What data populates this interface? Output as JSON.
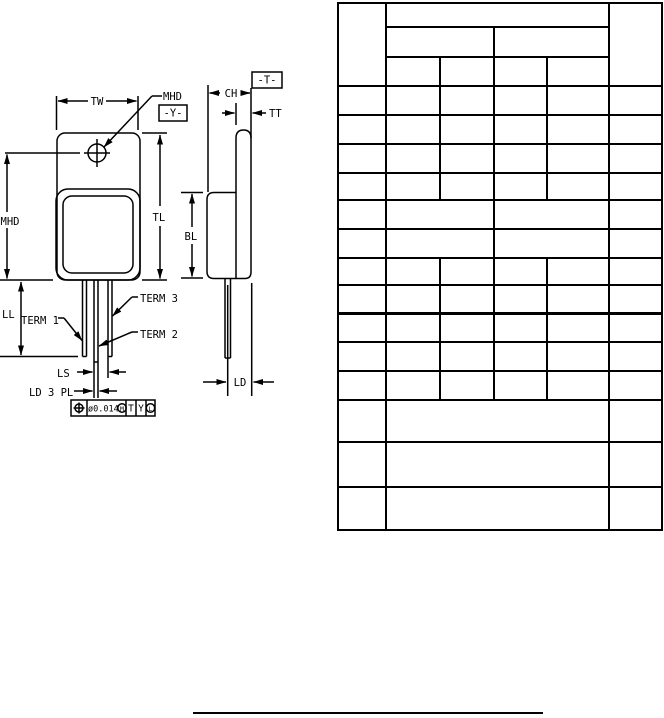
{
  "colors": {
    "ink": "#000000",
    "paper": "#ffffff"
  },
  "drawing": {
    "labels": {
      "tw": "TW",
      "mhd_leader": "MHD",
      "datum_y": "-Y-",
      "ch": "CH",
      "datum_t": "-T-",
      "tt": "TT",
      "tl": "TL",
      "bl": "BL",
      "mhd": "MHD",
      "ll": "LL",
      "term1": "TERM 1",
      "term2": "TERM 2",
      "term3": "TERM 3",
      "ls": "LS",
      "ld_3pl": "LD 3 PL",
      "ld": "LD"
    },
    "fcf": {
      "tolerance": "ø0.014",
      "modifier": "M",
      "datum_primary": "T",
      "datum_secondary": "Y",
      "datum_tertiary": "L"
    }
  },
  "table": {
    "left": 338,
    "top": 3,
    "width": 324,
    "height": 527,
    "h_lines": [
      {
        "y": 0,
        "x1": 0,
        "x2": 324
      },
      {
        "y": 24,
        "x1": 48,
        "x2": 271
      },
      {
        "y": 54,
        "x1": 48,
        "x2": 271
      },
      {
        "y": 83,
        "x1": 0,
        "x2": 324
      },
      {
        "y": 112,
        "x1": 0,
        "x2": 324
      },
      {
        "y": 141,
        "x1": 0,
        "x2": 324
      },
      {
        "y": 170,
        "x1": 0,
        "x2": 324
      },
      {
        "y": 197,
        "x1": 0,
        "x2": 324
      },
      {
        "y": 226,
        "x1": 0,
        "x2": 324
      },
      {
        "y": 255,
        "x1": 0,
        "x2": 324
      },
      {
        "y": 282,
        "x1": 0,
        "x2": 324
      },
      {
        "y": 310,
        "x1": 0,
        "x2": 324,
        "thick": true
      },
      {
        "y": 339,
        "x1": 0,
        "x2": 324
      },
      {
        "y": 368,
        "x1": 0,
        "x2": 324
      },
      {
        "y": 397,
        "x1": 0,
        "x2": 324
      },
      {
        "y": 439,
        "x1": 0,
        "x2": 324
      },
      {
        "y": 484,
        "x1": 0,
        "x2": 324
      },
      {
        "y": 527,
        "x1": 0,
        "x2": 324
      }
    ],
    "v_lines": [
      {
        "x": 0,
        "y1": 0,
        "y2": 527
      },
      {
        "x": 48,
        "y1": 0,
        "y2": 527
      },
      {
        "x": 102,
        "y1": 54,
        "y2": 197
      },
      {
        "x": 102,
        "y1": 255,
        "y2": 397
      },
      {
        "x": 156,
        "y1": 24,
        "y2": 397
      },
      {
        "x": 209,
        "y1": 54,
        "y2": 197
      },
      {
        "x": 209,
        "y1": 255,
        "y2": 397
      },
      {
        "x": 271,
        "y1": 0,
        "y2": 527
      },
      {
        "x": 324,
        "y1": 0,
        "y2": 527
      }
    ]
  }
}
